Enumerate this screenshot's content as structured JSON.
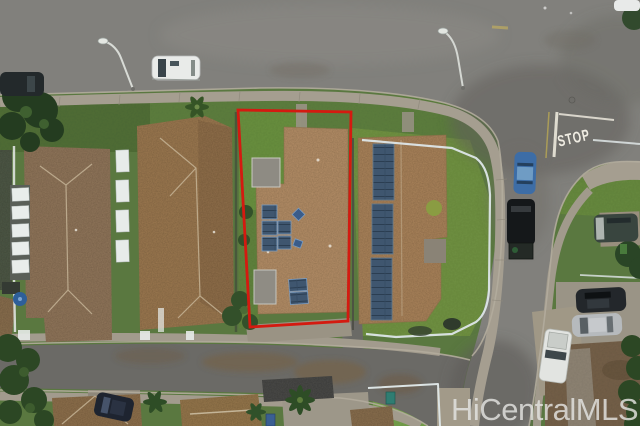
{
  "meta": {
    "type": "aerial-drone-photo",
    "description": "Aerial view of a residential neighborhood; subject property outlined in red"
  },
  "watermark": {
    "text": "HiCentralMLS",
    "color": "rgba(228,228,226,0.82)"
  },
  "road_markings": {
    "stop_text": "STOP",
    "paint_color": "#f0ede3"
  },
  "property_outline": {
    "color": "#d41a10",
    "points": "238,110 351,112 348,321 250,327"
  },
  "colors": {
    "asphalt": "#81807c",
    "asphalt_dark": "#5d5c58",
    "sidewalk": "#a59e90",
    "grass": "#5a7840",
    "grass_bright": "#6f9143",
    "roof_tan": "#b58f68",
    "roof_brown": "#9c7951",
    "solar_panel": "#3f566f",
    "dirt": "#75604a",
    "fence_white": "#dde6e8"
  },
  "scene": {
    "subject_property": "center lot outlined in red with tan shingle roof and rooftop solar panels",
    "vehicles": [
      {
        "label": "white van on top road",
        "color": "#e9ebe9"
      },
      {
        "label": "dark car top-left curb",
        "color": "#23292b"
      },
      {
        "label": "white car top-right corner",
        "color": "#e8eae9"
      },
      {
        "label": "blue car on side street",
        "color": "#3d6da6"
      },
      {
        "label": "dark SUV on side street",
        "color": "#15181a"
      },
      {
        "label": "gray van in right driveway",
        "color": "#39453f"
      },
      {
        "label": "dark car in right driveway",
        "color": "#23272b"
      },
      {
        "label": "silver car in right driveway",
        "color": "#b6babd"
      },
      {
        "label": "white pickup in right driveway",
        "color": "#e2e4e1"
      },
      {
        "label": "dark car in bottom driveway",
        "color": "#1e2430"
      }
    ],
    "features": [
      "stop bar and STOP pavement marking",
      "two street lights",
      "white perimeter fences",
      "palm trees",
      "solar water-heater panels on left lot"
    ]
  }
}
